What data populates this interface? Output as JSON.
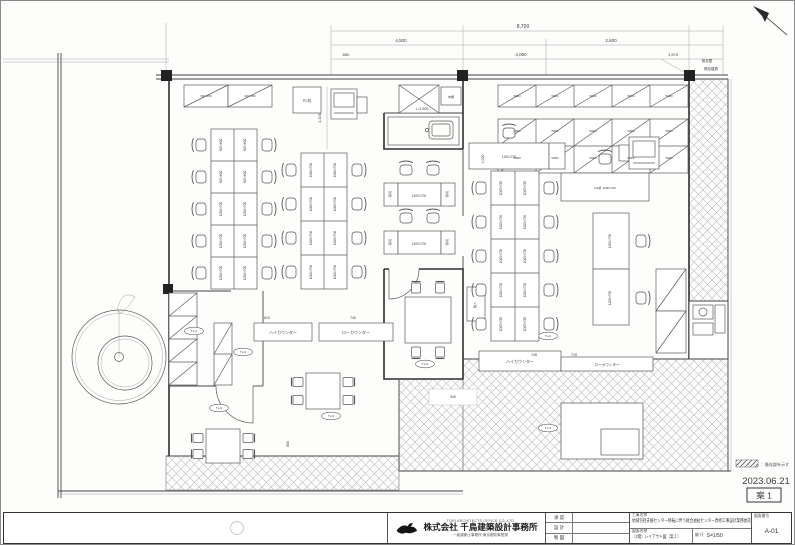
{
  "meta": {
    "date": "2023.06.21",
    "stamp_label": "案 1",
    "legend_text": "：既存部を示す"
  },
  "title_block": {
    "company_en": "TORI ARCHITECTS OFFICE CO.,LTD",
    "company": "株式会社 千鳥建築設計事務所",
    "company_sub": "一級建築士事務所 東京都知事登録",
    "approve_rows": [
      "承 認",
      "設 計",
      "製 図"
    ],
    "project_label": "工事名称",
    "project_name": "地域包括支援センター移転に伴う総合福祉センター改修工事設計業務委託",
    "drawing_label": "図面名称",
    "drawing_name": "（2階）レイアウト図（案１）",
    "scale_label": "縮 尺",
    "scale_value": "S=1/50",
    "number_label": "図面番号",
    "number_value": "A-01"
  },
  "plan": {
    "labels": [
      {
        "t": "900×600",
        "x": 221,
        "y": 144,
        "r": -90
      },
      {
        "t": "900×600",
        "x": 245,
        "y": 144,
        "r": -90
      },
      {
        "t": "900×600",
        "x": 221,
        "y": 176,
        "r": -90
      },
      {
        "t": "900×600",
        "x": 245,
        "y": 176,
        "r": -90
      },
      {
        "t": "1000×700",
        "x": 221,
        "y": 208,
        "r": -90
      },
      {
        "t": "1000×700",
        "x": 245,
        "y": 208,
        "r": -90
      },
      {
        "t": "1000×700",
        "x": 221,
        "y": 240,
        "r": -90
      },
      {
        "t": "1000×700",
        "x": 245,
        "y": 240,
        "r": -90
      },
      {
        "t": "1000×700",
        "x": 221,
        "y": 272,
        "r": -90
      },
      {
        "t": "1000×700",
        "x": 245,
        "y": 272,
        "r": -90
      },
      {
        "t": "1000×700",
        "x": 311,
        "y": 169,
        "r": -90
      },
      {
        "t": "1000×700",
        "x": 335,
        "y": 169,
        "r": -90
      },
      {
        "t": "1000×700",
        "x": 311,
        "y": 203,
        "r": -90
      },
      {
        "t": "1000×700",
        "x": 335,
        "y": 203,
        "r": -90
      },
      {
        "t": "1000×700",
        "x": 311,
        "y": 237,
        "r": -90
      },
      {
        "t": "1000×700",
        "x": 335,
        "y": 237,
        "r": -90
      },
      {
        "t": "1000×700",
        "x": 311,
        "y": 271,
        "r": -90
      },
      {
        "t": "1000×700",
        "x": 335,
        "y": 271,
        "r": -90
      },
      {
        "t": "1000×750",
        "x": 501,
        "y": 187,
        "r": -90
      },
      {
        "t": "1000×750",
        "x": 525,
        "y": 187,
        "r": -90
      },
      {
        "t": "1000×750",
        "x": 501,
        "y": 221,
        "r": -90
      },
      {
        "t": "1000×750",
        "x": 525,
        "y": 221,
        "r": -90
      },
      {
        "t": "1000×750",
        "x": 501,
        "y": 255,
        "r": -90
      },
      {
        "t": "1000×750",
        "x": 525,
        "y": 255,
        "r": -90
      },
      {
        "t": "1000×750",
        "x": 501,
        "y": 289,
        "r": -90
      },
      {
        "t": "1000×750",
        "x": 525,
        "y": 289,
        "r": -90
      },
      {
        "t": "1000×750",
        "x": 501,
        "y": 323,
        "r": -90
      },
      {
        "t": "1000×750",
        "x": 525,
        "y": 323,
        "r": -90
      },
      {
        "t": "1200×700",
        "x": 508,
        "y": 157
      },
      {
        "t": "1200×700",
        "x": 418,
        "y": 196
      },
      {
        "t": "1200×700",
        "x": 418,
        "y": 244
      },
      {
        "t": "脇机",
        "x": 390,
        "y": 193,
        "r": -90,
        "s": 2.8
      },
      {
        "t": "脇机",
        "x": 447,
        "y": 193,
        "r": -90,
        "s": 2.8
      },
      {
        "t": "脇机",
        "x": 390,
        "y": 241,
        "r": -90,
        "s": 2.8
      },
      {
        "t": "脇机",
        "x": 447,
        "y": 241,
        "r": -90,
        "s": 2.8
      },
      {
        "t": "OA机 1600×700",
        "x": 604,
        "y": 188,
        "s": 3
      },
      {
        "t": "1200×750",
        "x": 610,
        "y": 240,
        "r": -90
      },
      {
        "t": "1200×750",
        "x": 610,
        "y": 297,
        "r": -90
      },
      {
        "t": "PC机",
        "x": 306,
        "y": 101,
        "s": 3.5
      },
      {
        "t": "中棚",
        "x": 450,
        "y": 97,
        "s": 3
      },
      {
        "t": "L=1,800",
        "x": 421,
        "y": 109,
        "s": 3.5
      },
      {
        "t": "物入",
        "x": 475,
        "y": 304,
        "r": -90,
        "s": 3
      },
      {
        "t": "ハイカウンター",
        "x": 282,
        "y": 333,
        "s": 4
      },
      {
        "t": "ローカウンター",
        "x": 355,
        "y": 333,
        "s": 4
      },
      {
        "t": "ハイカウンター",
        "x": 519,
        "y": 362,
        "s": 4
      },
      {
        "t": "ローカウンター",
        "x": 606,
        "y": 365,
        "s": 3.6
      },
      {
        "t": "900×450",
        "x": 205,
        "y": 96,
        "s": 2.8
      },
      {
        "t": "900×450",
        "x": 249,
        "y": 96,
        "s": 2.8
      },
      {
        "t": "W900",
        "x": 516,
        "y": 96,
        "s": 2.8
      },
      {
        "t": "W900",
        "x": 554,
        "y": 96,
        "s": 2.8
      },
      {
        "t": "W900",
        "x": 592,
        "y": 96,
        "s": 2.8
      },
      {
        "t": "W900",
        "x": 630,
        "y": 96,
        "s": 2.8
      },
      {
        "t": "W900",
        "x": 668,
        "y": 96,
        "s": 2.8
      },
      {
        "t": "W900",
        "x": 516,
        "y": 131,
        "s": 2.8
      },
      {
        "t": "W900",
        "x": 554,
        "y": 131,
        "s": 2.8
      },
      {
        "t": "W900",
        "x": 592,
        "y": 131,
        "s": 2.8
      },
      {
        "t": "W900",
        "x": 630,
        "y": 131,
        "s": 2.8
      },
      {
        "t": "W900",
        "x": 668,
        "y": 131,
        "s": 2.8
      },
      {
        "t": "W900",
        "x": 516,
        "y": 158,
        "s": 2.8
      },
      {
        "t": "W900",
        "x": 554,
        "y": 158,
        "s": 2.8
      },
      {
        "t": "W900",
        "x": 592,
        "y": 158,
        "s": 2.8
      },
      {
        "t": "W900",
        "x": 630,
        "y": 158,
        "s": 2.8
      },
      {
        "t": "W900",
        "x": 668,
        "y": 158,
        "s": 2.8
      },
      {
        "t": "8,700",
        "x": 522,
        "y": 27,
        "s": 5
      },
      {
        "t": "4,500",
        "x": 400,
        "y": 41,
        "s": 4.5
      },
      {
        "t": "2,600",
        "x": 610,
        "y": 41,
        "s": 4.5
      },
      {
        "t": "850",
        "x": 345,
        "y": 55,
        "s": 4
      },
      {
        "t": "4,000",
        "x": 520,
        "y": 55,
        "s": 4.5
      },
      {
        "t": "1,570",
        "x": 672,
        "y": 55,
        "s": 4
      },
      {
        "t": "1,100",
        "x": 320,
        "y": 117,
        "r": -90,
        "s": 4
      },
      {
        "t": "1,000",
        "x": 483,
        "y": 158,
        "r": -90,
        "s": 3.5
      },
      {
        "t": "745",
        "x": 533,
        "y": 355,
        "s": 3.5
      },
      {
        "t": "715",
        "x": 573,
        "y": 355,
        "s": 3.5
      },
      {
        "t": "940",
        "x": 452,
        "y": 397,
        "s": 3.5
      },
      {
        "t": "800",
        "x": 288,
        "y": 443,
        "r": -90,
        "s": 3.5
      },
      {
        "t": "810",
        "x": 266,
        "y": 318,
        "s": 3.5
      },
      {
        "t": "740",
        "x": 352,
        "y": 318,
        "s": 3.5
      },
      {
        "t": "既存壁",
        "x": 706,
        "y": 61,
        "s": 3.5
      },
      {
        "t": "既存建具",
        "x": 710,
        "y": 69,
        "s": 3.5
      }
    ],
    "ovals": [
      {
        "t": "TL-4",
        "x": 193,
        "y": 330
      },
      {
        "t": "TL-6",
        "x": 242,
        "y": 351
      },
      {
        "t": "TL-6",
        "x": 424,
        "y": 363
      },
      {
        "t": "TL-6",
        "x": 218,
        "y": 407
      },
      {
        "t": "TL-5",
        "x": 330,
        "y": 415
      },
      {
        "t": "TL-6",
        "x": 547,
        "y": 335
      },
      {
        "t": "TL-3",
        "x": 547,
        "y": 427
      }
    ]
  }
}
